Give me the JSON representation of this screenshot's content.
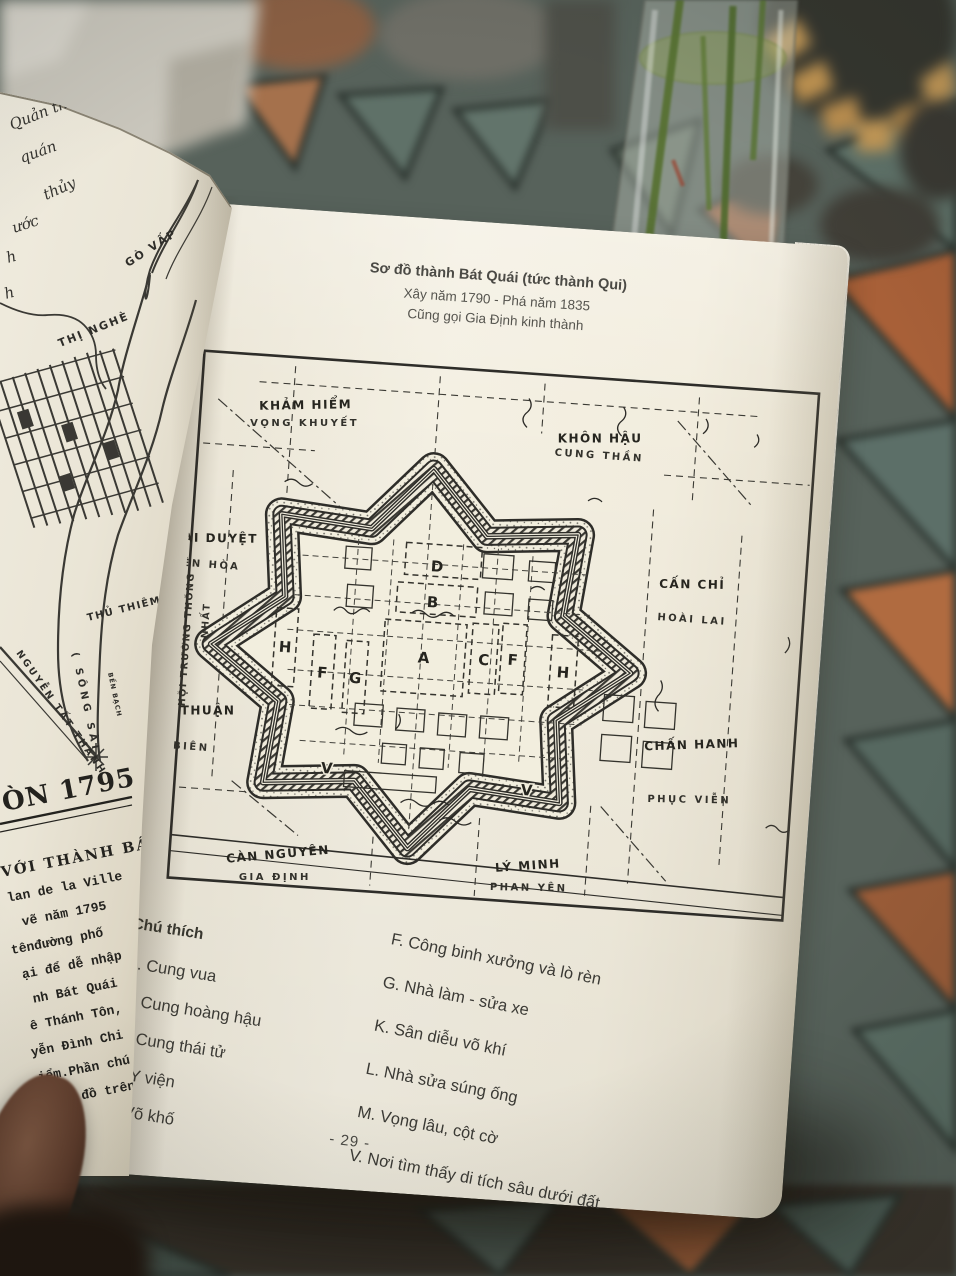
{
  "colors": {
    "paper": "#f2eede",
    "ink": "#2e2d29",
    "tile_slate": "#5c6f68",
    "tile_terracotta": "#a86038",
    "tile_tan": "#c59a58",
    "grout": "#2b332e",
    "stem_green": "#55702f",
    "thumb_skin": "#6b4a36"
  },
  "right_page": {
    "title": {
      "line1": "Sơ đồ thành Bát Quái (tức thành Qui)",
      "line2": "Xây năm 1790 - Phá năm 1835",
      "line3": "Cũng gọi Gia Định kinh thành"
    },
    "map": {
      "gates": {
        "top_left": {
          "name": "KHẢM HIỂM",
          "alt": "VỌNG KHUYẾT"
        },
        "top_right": {
          "name": "KHÔN HẬU",
          "alt": "CUNG THẦN"
        },
        "right_upper": {
          "name": "CẤN CHỈ",
          "alt": "HOÀI LAI"
        },
        "right_lower": {
          "name": "CHẤN HANH",
          "alt": "PHỤC VIỄN"
        },
        "bottom_right": {
          "name": "LÝ MINH",
          "alt": "PHAN YÊN"
        },
        "bottom_left": {
          "name": "CÀN NGUYÊN",
          "alt": "GIA ĐỊNH"
        },
        "left_upper": {
          "name": "ĐOÀI DUYỆT",
          "alt": "YÊN HÒA"
        },
        "left_lower": {
          "name": "TỐN THUẬN",
          "alt": "AN BIÊN"
        }
      },
      "street": {
        "line1": "HỘI TRƯỜNG THỐNG",
        "line2": "NHẤT"
      },
      "letters": {
        "a": "A",
        "b": "B",
        "c": "C",
        "d": "D",
        "f_left": "F",
        "f_right": "F",
        "g": "G",
        "h_left": "H",
        "h_right": "H",
        "v_left": "V",
        "v_right": "V"
      }
    },
    "legend": {
      "heading": "Chú thích",
      "left_items": [
        "A. Cung vua",
        "B. Cung hoàng hậu",
        "C. Cung thái tử",
        "D. Y viện",
        "E. Võ khố"
      ],
      "right_items": [
        "F. Công binh xưởng và lò rèn",
        "G. Nhà làm - sửa xe",
        "K. Sân diễu võ khí",
        "L. Nhà sửa súng ống",
        "M. Vọng lâu, cột cờ",
        "V. Nơi tìm thấy di tích sâu dưới đất"
      ]
    },
    "page_number": "- 29 -"
  },
  "left_page": {
    "handwritten": [
      "Quản thảo",
      "quán",
      "thủy",
      "ước",
      "h",
      "h"
    ],
    "map_labels": {
      "go_vap": "GÒ VẤP",
      "thi_nghe": "THỊ NGHÈ",
      "thu_thiem": "THỦ THIÊM",
      "song_sai": "( SÔNG  SÀI",
      "nguyen_tat_thanh": "NGUYỄN TẤT THÀNH",
      "ben": "BẾN BẠCH"
    },
    "caption_title": "ÒN 1795",
    "caption_sub": "VỚI THÀNH BÁT",
    "typed_lines": [
      "lan de la Ville",
      "vẽ năm 1795",
      "tênđường phố",
      "ại để dễ nhập",
      "nh Bát Quái",
      "ê Thánh Tôn,",
      "yễn Đình Chi",
      "iểm.Phần chú",
      "ban đồ trên."
    ]
  }
}
